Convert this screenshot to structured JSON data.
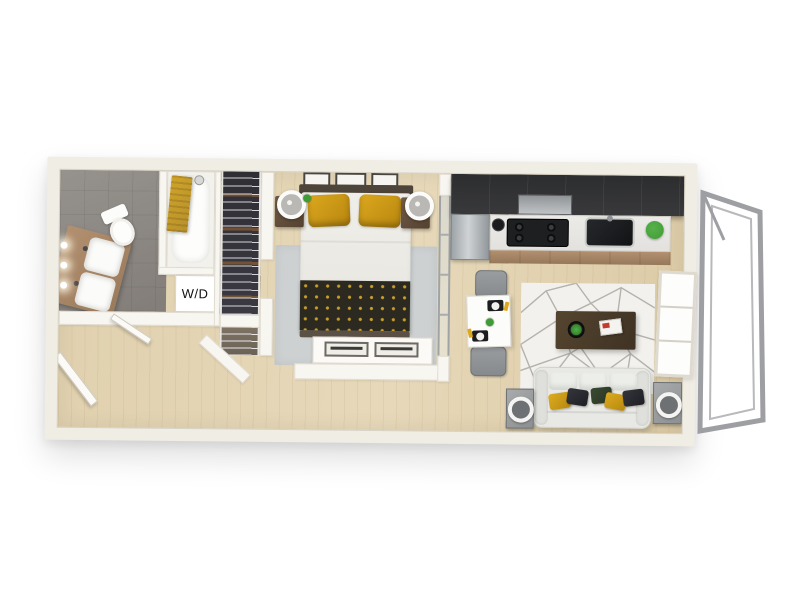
{
  "title": "3D apartment floor plan render",
  "labels": {
    "washer_dryer": "W/D"
  },
  "palette": {
    "bg": "#ffffff",
    "wall-top": "#f0ede5",
    "wood": "#e0d0ae",
    "tile": "#96928d",
    "tile-dark": "#827d78",
    "counter": "#e2e1dd",
    "cabinet-wood": "#b29070",
    "kitchen-dark": "#39393b",
    "appliance-black": "#1d1f21",
    "towel-yellow": "#cfa42a",
    "pillow-yellow": "#dca81e",
    "throw-dark": "#2b2920",
    "throw-dot": "#c89d2a",
    "rug-gray": "#cdd1d2",
    "rug-living": "#f2f1ed",
    "rug-line": "#b5b2ac",
    "sofa": "#e8e9e5",
    "table-dark": "#3f3224",
    "chair-gray": "#85898c",
    "closet-dark": "#2f2e35",
    "plant-green": "#3f9b35",
    "headboard": "#4d443a",
    "nightstand": "#6f5b47",
    "railing": "#9d9fa2"
  },
  "rooms": [
    {
      "name": "bathroom",
      "items": [
        "double-sink-vanity",
        "toilet",
        "bathtub",
        "yellow-towel",
        "shower-head",
        "sconce-lights"
      ]
    },
    {
      "name": "laundry-closet",
      "items": [
        "washer-dryer"
      ]
    },
    {
      "name": "walk-in-closet",
      "items": [
        "wire-shelving",
        "hanging-clothes"
      ]
    },
    {
      "name": "entry",
      "items": [
        "entry-door"
      ]
    },
    {
      "name": "bedroom",
      "items": [
        "bed",
        "yellow-pillows",
        "patterned-throw",
        "wall-art",
        "nightstands",
        "ring-lamps",
        "area-rug",
        "dresser",
        "glass-partition"
      ]
    },
    {
      "name": "kitchen",
      "items": [
        "upper-cabinets",
        "range-hood",
        "cooktop",
        "sink",
        "refrigerator",
        "base-cabinets",
        "plant",
        "kettle"
      ]
    },
    {
      "name": "living-dining",
      "items": [
        "dining-table",
        "dining-chairs",
        "place-settings",
        "geometric-rug",
        "coffee-table",
        "sofa",
        "throw-pillows",
        "side-tables",
        "window"
      ]
    },
    {
      "name": "balcony",
      "items": [
        "metal-railing"
      ]
    }
  ]
}
